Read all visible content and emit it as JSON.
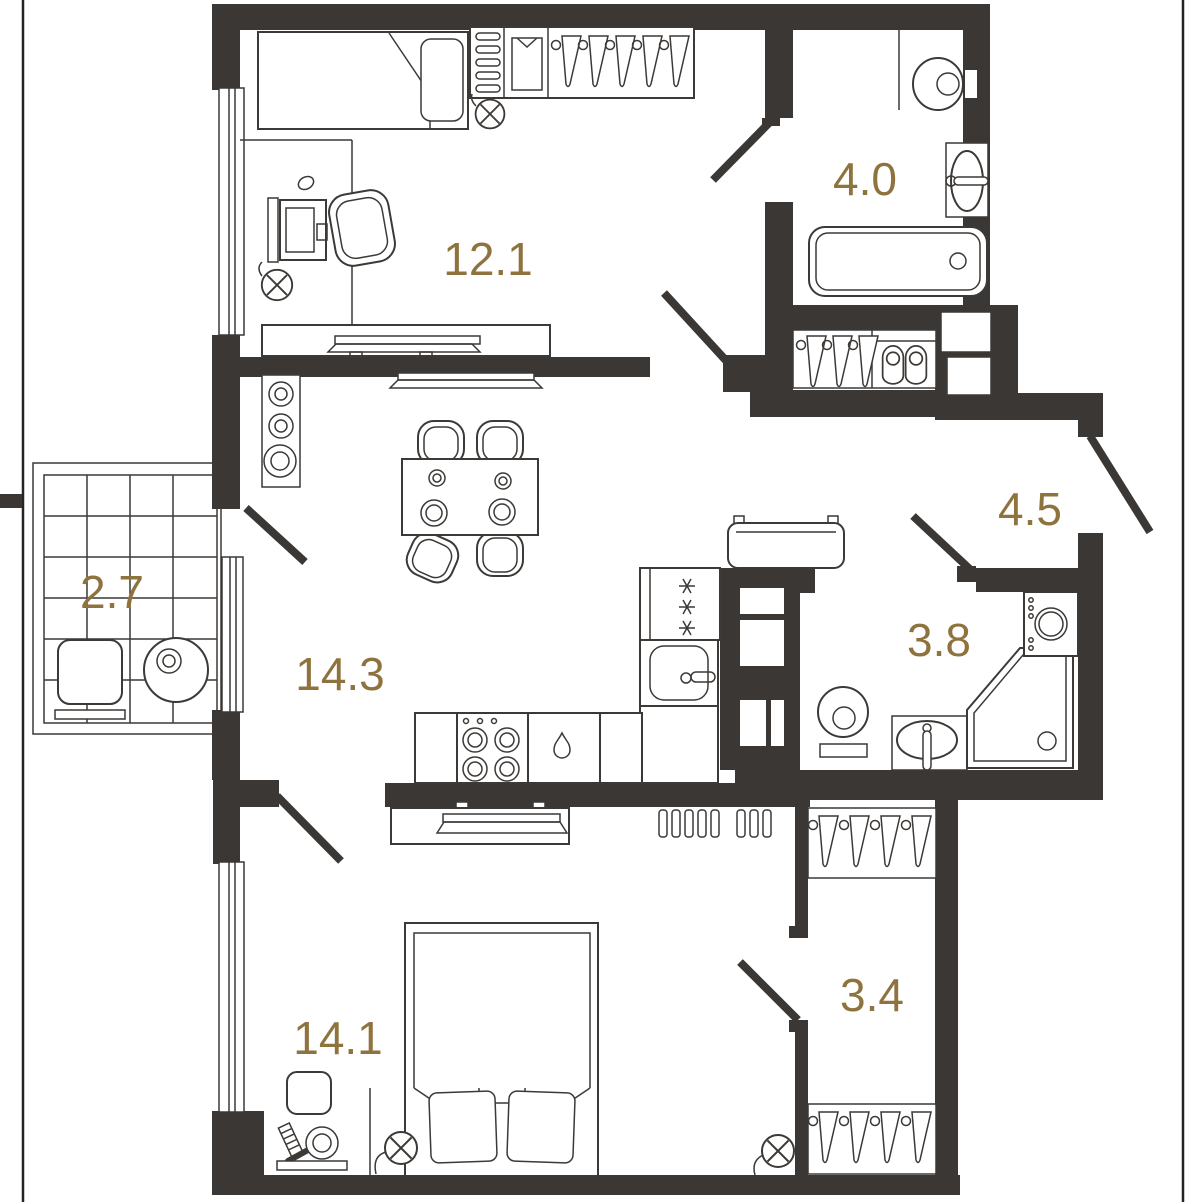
{
  "palette": {
    "wall": "#3B3735",
    "line": "#3C3936",
    "accent": "#8E733E",
    "background": "#FFFFFF"
  },
  "rooms": [
    {
      "id": "bedroom-1",
      "area_label": "12.1"
    },
    {
      "id": "ensuite-bathroom",
      "area_label": "4.0"
    },
    {
      "id": "balcony",
      "area_label": "2.7"
    },
    {
      "id": "living-kitchen",
      "area_label": "14.3"
    },
    {
      "id": "hallway",
      "area_label": "4.5"
    },
    {
      "id": "bathroom",
      "area_label": "3.8"
    },
    {
      "id": "walk-in-closet",
      "area_label": "3.4"
    },
    {
      "id": "bedroom-2",
      "area_label": "14.1"
    }
  ]
}
